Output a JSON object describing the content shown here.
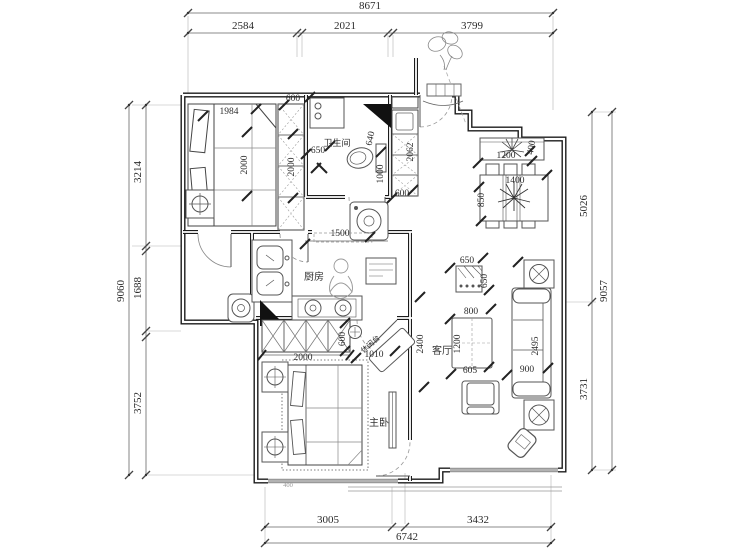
{
  "plan": {
    "rooms": {
      "bathroom": "卫生间",
      "kitchen": "厨房",
      "living_room": "客厅",
      "master_bedroom": "主卧",
      "leisure_counter": "休闲台"
    },
    "outer_dims": {
      "top_total": "8671",
      "top_seg1": "2584",
      "top_seg2": "2021",
      "top_seg3": "3799",
      "left_total": "9060",
      "left_seg1": "3214",
      "left_seg2": "1688",
      "left_seg3": "3752",
      "right_total": "9057",
      "right_seg1": "5026",
      "right_seg2": "3731",
      "bottom_total": "6742",
      "bottom_seg1": "3005",
      "bottom_seg2": "3432"
    },
    "inner_dims": {
      "bed2_width": "1984",
      "wardrobe2_depth": "600",
      "bed2_length": "2000",
      "wardrobe2_length": "2000",
      "bath_width": "650",
      "toilet_width": "640",
      "bath_length": "1000",
      "cabinet_length": "2062",
      "cabinet_width": "600",
      "planter_width": "1200",
      "planter_depth": "400",
      "dining_table_width": "1400",
      "dining_table_depth": "850",
      "kitchen_opening": "1500",
      "flower_stand_width": "650",
      "flower_stand_depth": "650",
      "coffee_table_width": "800",
      "coffee_table_length": "1200",
      "coffee_table_side": "605",
      "sofa_length": "2495",
      "sofa_depth": "900",
      "hallway_length": "2400",
      "master_wardrobe_width": "2000",
      "master_wardrobe_depth": "600",
      "master_door_width": "1010",
      "window_seg": "400"
    }
  }
}
